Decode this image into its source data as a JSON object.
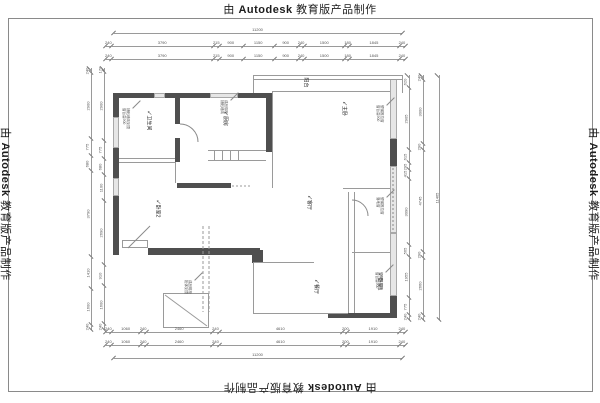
{
  "watermark": {
    "prefix": "由",
    "brand": "Autodesk",
    "suffix": "教育版产品制作"
  },
  "plan": {
    "rooms": [
      {
        "label": "卫生间"
      },
      {
        "label": "厨房"
      },
      {
        "label": "主卧"
      },
      {
        "label": "卧室2"
      },
      {
        "label": "客厅"
      },
      {
        "label": "餐厅"
      },
      {
        "label": "卧室1"
      },
      {
        "label": "阳台"
      }
    ],
    "annotations": [
      {
        "lines": [
          "铺贴墙砖到顶",
          "窗台高900"
        ]
      },
      {
        "lines": [
          "成品橱柜",
          "铺贴墙砖"
        ]
      },
      {
        "lines": [
          "塑钢推拉窗",
          "窗台高900"
        ]
      },
      {
        "lines": [
          "塑钢推拉窗",
          "落地窗"
        ]
      },
      {
        "lines": [
          "塑钢推拉窗",
          "窗台高900"
        ]
      },
      {
        "lines": [
          "成品鞋柜",
          "柜体到顶"
        ]
      }
    ]
  },
  "dims": {
    "top_total": [
      11200
    ],
    "top_row1": [
      240,
      3790,
      215,
      900,
      1150,
      900,
      240,
      1500,
      180,
      1845,
      240
    ],
    "top_row2": [
      240,
      3790,
      215,
      900,
      1150,
      900,
      240,
      1500,
      180,
      1845,
      240
    ],
    "bottom_row1": [
      240,
      1060,
      240,
      2460,
      240,
      4610,
      200,
      1910,
      240
    ],
    "bottom_row2": [
      240,
      1060,
      240,
      2460,
      240,
      4610,
      200,
      1910,
      240
    ],
    "bottom_total": [
      11200
    ],
    "left_outer": [
      240,
      2900,
      775,
      680,
      3790,
      1410,
      1600,
      240
    ],
    "left_inner": [
      170,
      2900,
      775,
      680,
      1100,
      2690,
      910,
      1600,
      240
    ],
    "right_inner": [
      620,
      2905,
      615,
      295,
      415,
      3090,
      565,
      1955,
      775,
      240
    ],
    "right_outer": [
      240,
      3000,
      290,
      4745,
      290,
      2660,
      240
    ],
    "right_total": [
      11465
    ]
  }
}
